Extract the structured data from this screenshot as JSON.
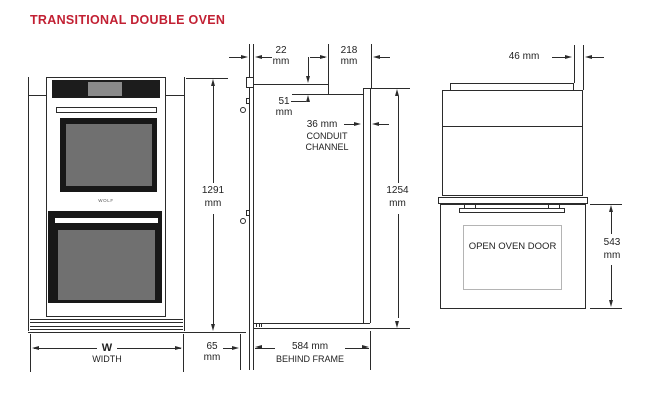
{
  "title": "TRANSITIONAL DOUBLE OVEN",
  "brand": "WOLF",
  "colors": {
    "title_red": "#c22033",
    "line": "#2b2b2b"
  },
  "front_view": {
    "width_symbol": "W",
    "width_label": "WIDTH"
  },
  "side_view": {
    "door_thickness": {
      "value": "22",
      "unit": "mm"
    },
    "rear_top_depth": {
      "value": "218",
      "unit": "mm"
    },
    "top_step": {
      "value": "51",
      "unit": "mm"
    },
    "conduit_channel": {
      "value": "36 mm",
      "label_line1": "CONDUIT",
      "label_line2": "CHANNEL"
    },
    "frame_height": {
      "value": "1291",
      "unit": "mm"
    },
    "height_behind_frame": {
      "value": "1254",
      "unit": "mm"
    },
    "front_projection": {
      "value": "65",
      "unit": "mm"
    },
    "depth_behind_frame": {
      "value": "584 mm",
      "label": "BEHIND FRAME"
    }
  },
  "open_door_view": {
    "top_reveal": "46 mm",
    "door_label": "OPEN OVEN DOOR",
    "open_depth": {
      "value": "543",
      "unit": "mm"
    }
  }
}
